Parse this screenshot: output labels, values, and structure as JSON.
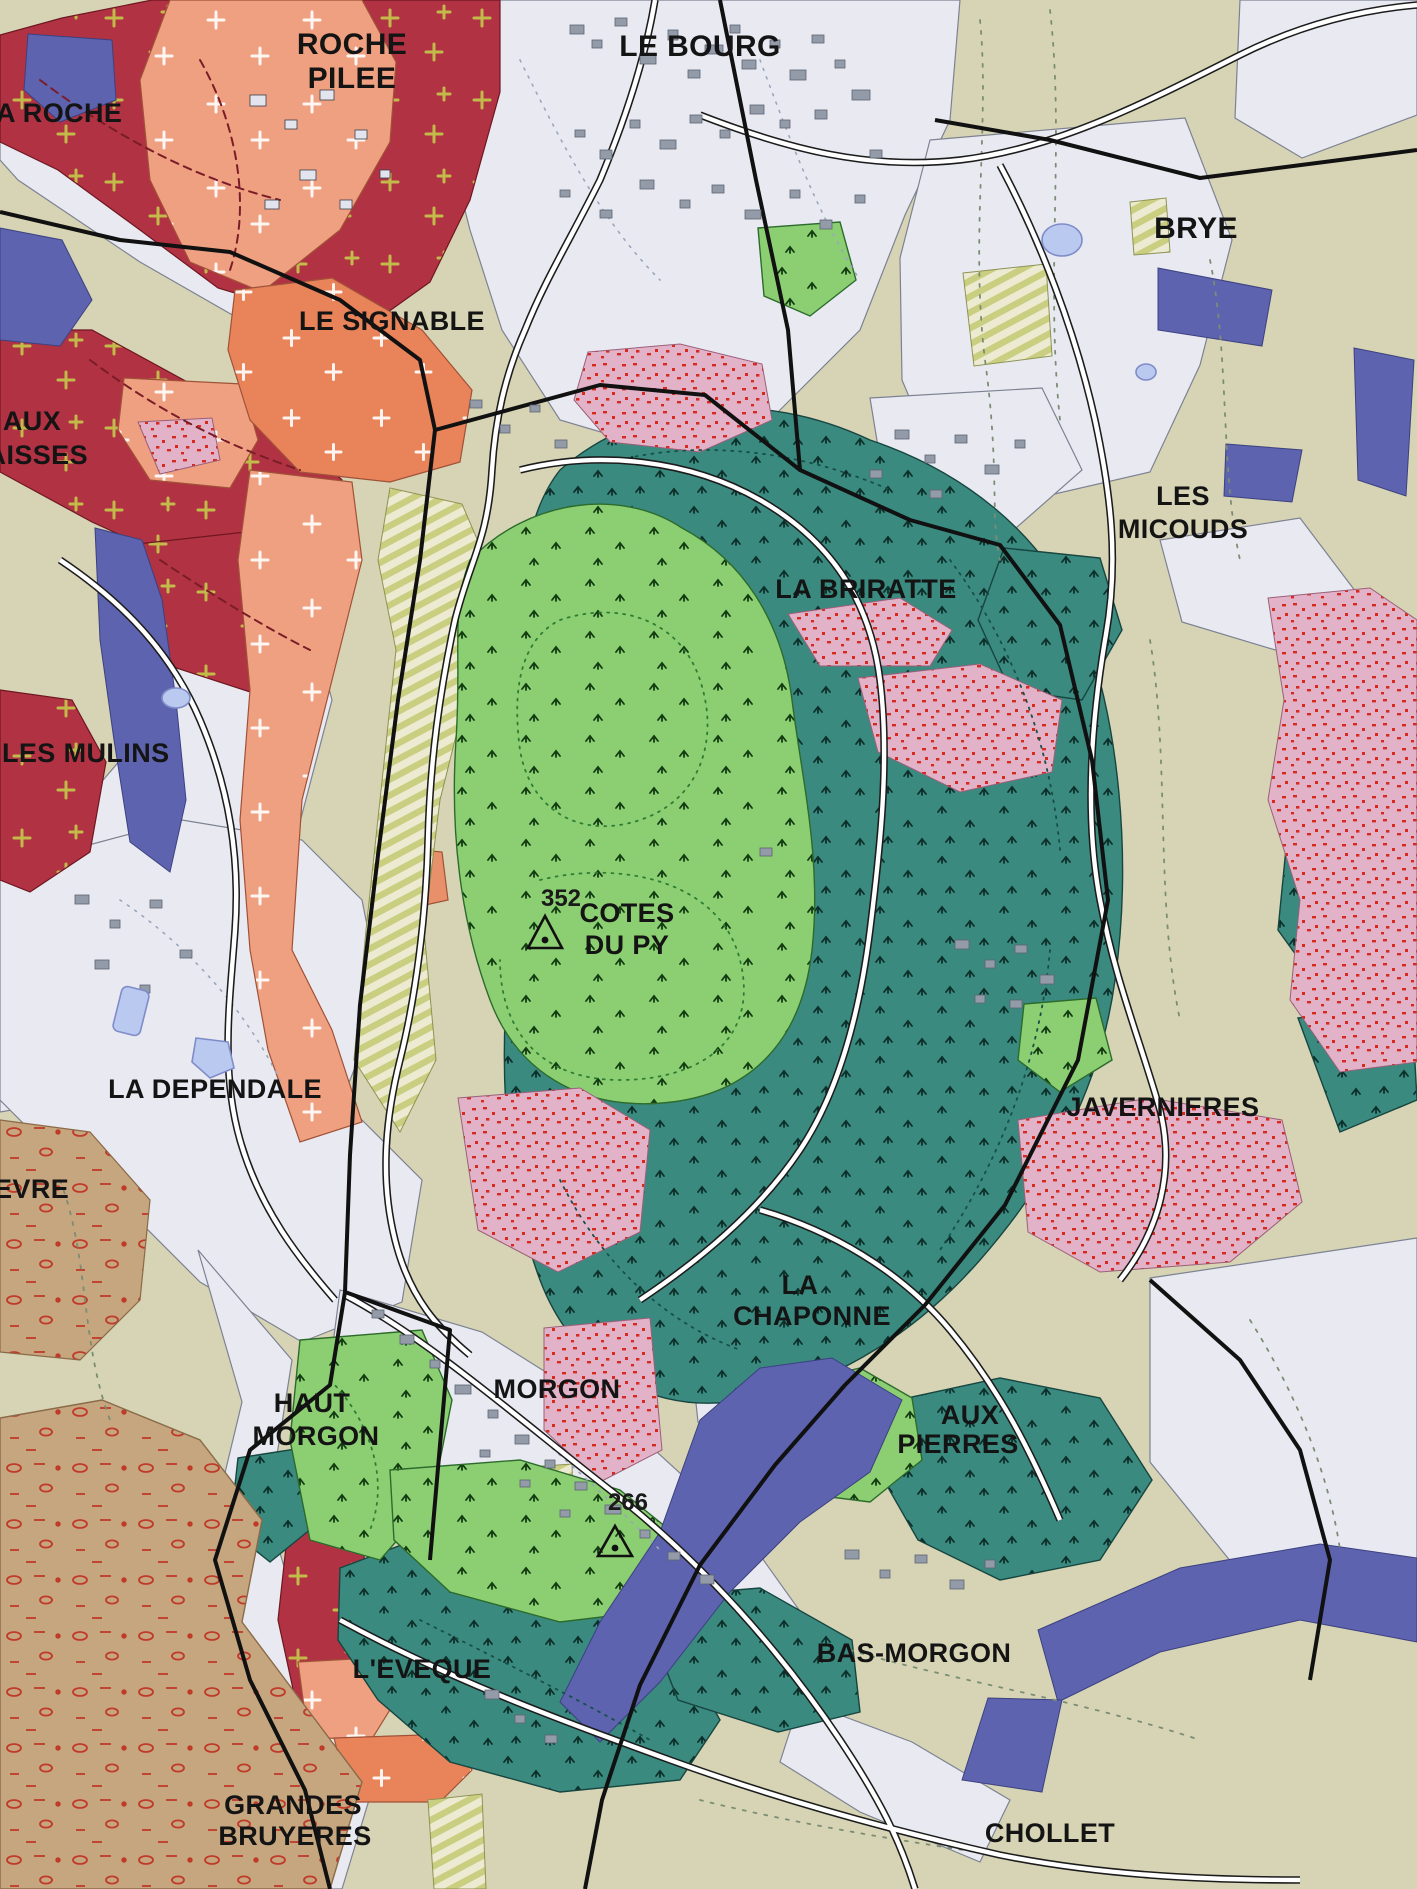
{
  "map": {
    "place_labels": {
      "la_roche": {
        "text": "A ROCHE"
      },
      "roche_pilee": {
        "lines": [
          "ROCHE",
          "PILEE"
        ]
      },
      "le_bourg": {
        "text": "LE BOURG"
      },
      "brye": {
        "text": "BRYE"
      },
      "le_signable": {
        "text": "LE SIGNABLE"
      },
      "aux_baisses": {
        "lines": [
          "AUX",
          "BAISSES"
        ]
      },
      "les_micouds": {
        "lines": [
          "LES",
          "MICOUDS"
        ]
      },
      "la_briratte": {
        "text": "LA BRIRATTE"
      },
      "les_mulins": {
        "text": "LES MULINS"
      },
      "cotes_du_py": {
        "lines": [
          "COTES",
          "DU PY"
        ]
      },
      "la_dependale": {
        "text": "LA DEPENDALE"
      },
      "javernieres": {
        "text": "JAVERNIERES"
      },
      "la_chaponne": {
        "lines": [
          "LA",
          "CHAPONNE"
        ]
      },
      "haut_morgon": {
        "lines": [
          "HAUT",
          "MORGON"
        ]
      },
      "morgon": {
        "text": "MORGON"
      },
      "aux_pierres": {
        "lines": [
          "AUX",
          "PIERRES"
        ]
      },
      "l_eveque": {
        "text": "L'EVEQUE"
      },
      "bas_morgon": {
        "text": "BAS-MORGON"
      },
      "grandes_bruyeres": {
        "lines": [
          "GRANDES",
          "BRUYERES"
        ]
      },
      "chollet": {
        "text": "CHOLLET"
      },
      "evre_fragment": {
        "text": "EVRE"
      }
    },
    "elevation_points": {
      "cotes_du_py_summit": {
        "value": "352"
      },
      "morgon_east_point": {
        "value": "266"
      }
    },
    "icons": {
      "elevation_marker_icon": "triangle-with-dot"
    },
    "colors": {
      "carmine_granite": "#b13243",
      "salmon_arene": "#efa080",
      "orange_slope": "#e8835a",
      "teal_schist": "#3a8a80",
      "light_green_schist": "#8ccf72",
      "pink_stipple": "#e2b3c8",
      "stipple_dot": "#d62a1e",
      "violet_alluvium": "#5d63ae",
      "beige_fields": "#d6d4b4",
      "white_valley": "#e9eaf1",
      "tan_gravel": "#c6a67e",
      "hatch_band": "#c9ce80",
      "pond_blue": "#b9c9f0",
      "building_gray": "#939aa8",
      "label_black": "#141414"
    }
  }
}
